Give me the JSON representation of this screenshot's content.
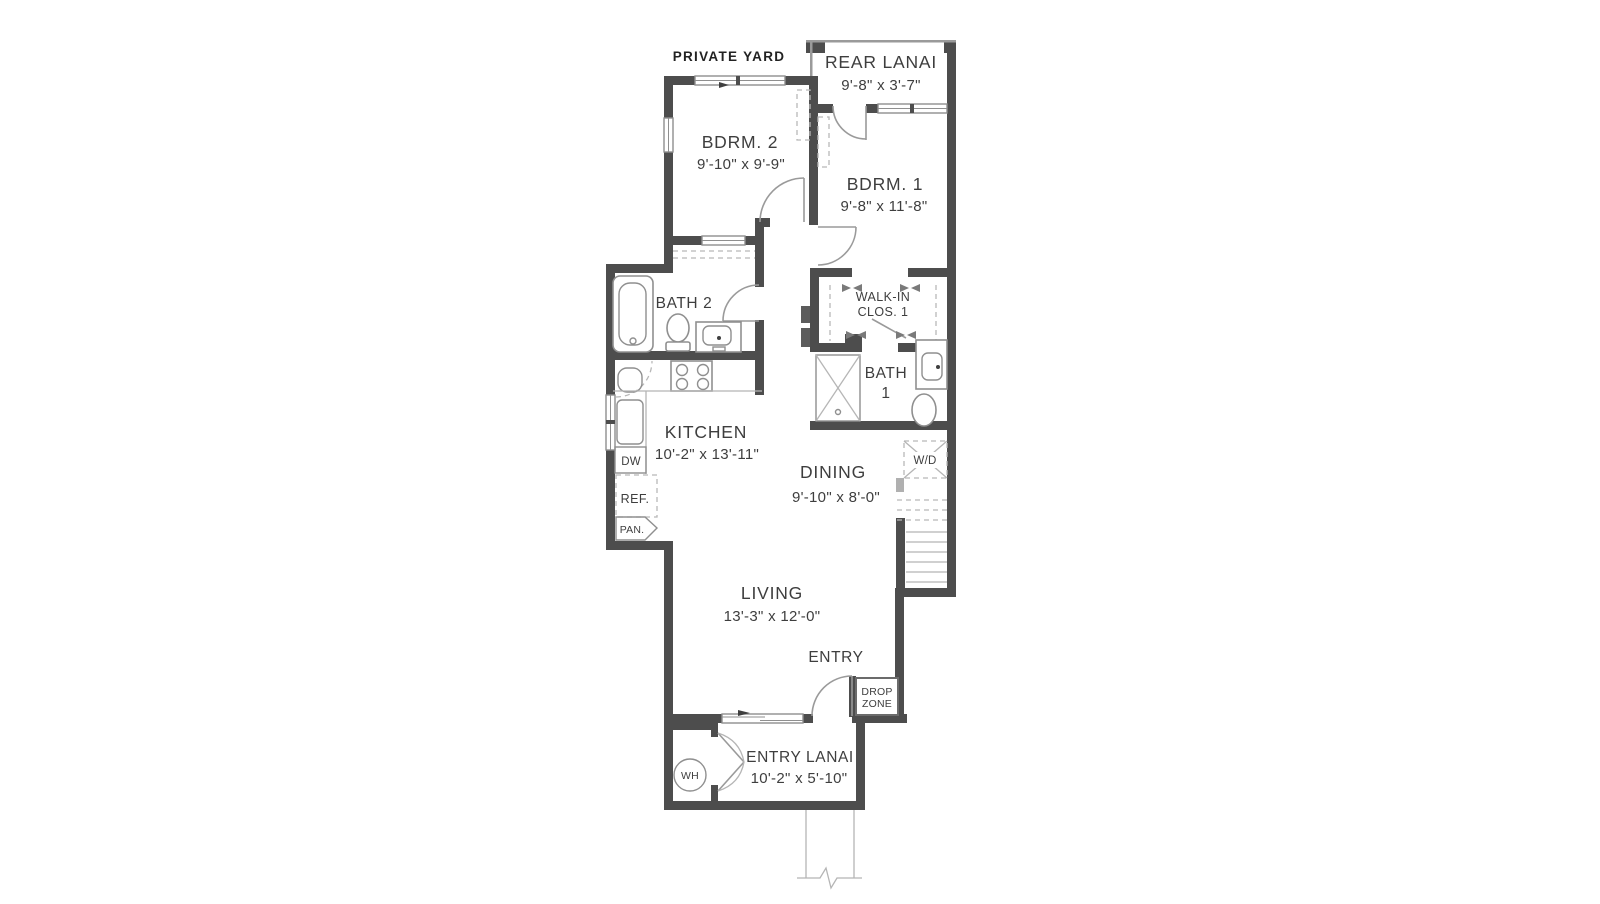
{
  "labels": {
    "private_yard": "PRIVATE YARD",
    "rear_lanai": {
      "name": "REAR LANAI",
      "dims": "9'-8\" x 3'-7\""
    },
    "bdrm2": {
      "name": "BDRM. 2",
      "dims": "9'-10\" x 9'-9\""
    },
    "bdrm1": {
      "name": "BDRM. 1",
      "dims": "9'-8\" x 11'-8\""
    },
    "bath2": {
      "name": "BATH 2"
    },
    "walkin_clos1": {
      "line1": "WALK-IN",
      "line2": "CLOS. 1"
    },
    "bath1": {
      "line1": "BATH",
      "line2": "1"
    },
    "kitchen": {
      "name": "KITCHEN",
      "dims": "10'-2\" x 13'-11\""
    },
    "dining": {
      "name": "DINING",
      "dims": "9'-10\" x 8'-0\""
    },
    "living": {
      "name": "LIVING",
      "dims": "13'-3\" x 12'-0\""
    },
    "entry": {
      "name": "ENTRY"
    },
    "drop_zone": {
      "line1": "DROP",
      "line2": "ZONE"
    },
    "entry_lanai": {
      "name": "ENTRY LANAI",
      "dims": "10'-2\" x 5'-10\""
    },
    "appliances": {
      "dw": "DW",
      "ref": "REF.",
      "pan": "PAN.",
      "wd": "W/D",
      "wh": "WH"
    }
  },
  "colors": {
    "wall": "#4d4d4d",
    "thin_line": "#9a9a9a",
    "dashed_line": "#b8b8b8",
    "text": "#3e3e3e",
    "background": "#ffffff"
  }
}
